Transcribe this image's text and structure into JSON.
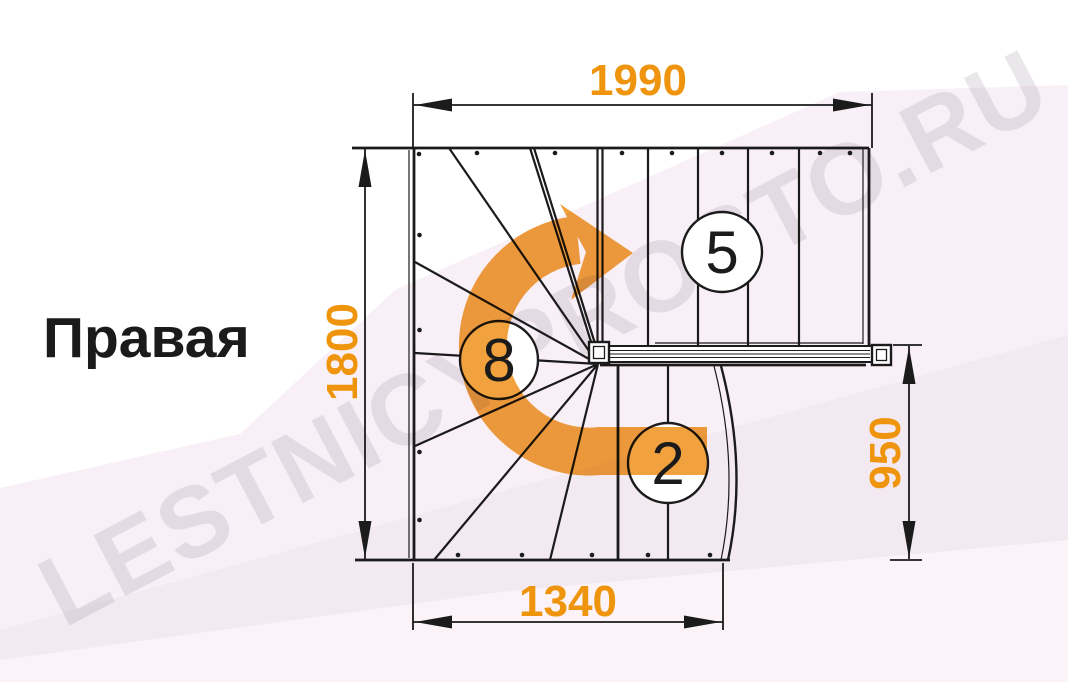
{
  "title": "Правая",
  "watermark": "LESTNICYPROSTO.RU",
  "dimensions": {
    "top": "1990",
    "left": "1800",
    "right": "950",
    "bottom": "1340"
  },
  "step_counts": {
    "top_flight": "5",
    "winders": "8",
    "bottom_flight": "2"
  },
  "colors": {
    "line": "#1b1b1b",
    "dimension_text": "#ef940d",
    "arrow": "#f1a23e",
    "watermark": "#8a8090",
    "bg_tint1": "#f9eff6",
    "bg_tint2": "#f3e9f1",
    "bg_tint3": "#fbf3f8",
    "paper": "#ffffff"
  }
}
